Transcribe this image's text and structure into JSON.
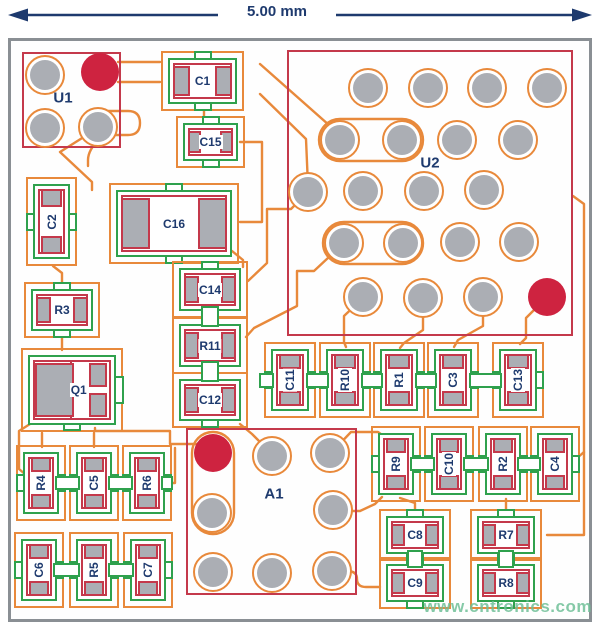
{
  "dimension": {
    "label": "5.00 mm"
  },
  "watermark": "www.cntronics.com",
  "colors": {
    "trace_orange": "#E8893B",
    "mask_green": "#2FA14D",
    "silk_red": "#C4394B",
    "pad_gray": "#ABAEB4",
    "mark_red": "#CE2340",
    "text_navy": "#1E3A6E",
    "board_border": "#8A8F94"
  },
  "chips": [
    {
      "label": "U1",
      "x": 22,
      "y": 52,
      "w": 99,
      "h": 96,
      "label_cx": 41,
      "label_cy": 46,
      "pads": [
        {
          "cx": 45,
          "cy": 75,
          "kind": "ring"
        },
        {
          "cx": 100,
          "cy": 72,
          "kind": "mark"
        },
        {
          "cx": 45,
          "cy": 128,
          "kind": "ring"
        },
        {
          "cx": 98,
          "cy": 127,
          "kind": "ring"
        }
      ]
    },
    {
      "label": "U2",
      "x": 287,
      "y": 50,
      "w": 286,
      "h": 286,
      "label_cx": 143,
      "label_cy": 113,
      "pads": [
        {
          "cx": 368,
          "cy": 88,
          "kind": "ring"
        },
        {
          "cx": 428,
          "cy": 88,
          "kind": "ring"
        },
        {
          "cx": 487,
          "cy": 88,
          "kind": "ring"
        },
        {
          "cx": 547,
          "cy": 88,
          "kind": "ring"
        },
        {
          "cx": 340,
          "cy": 140,
          "kind": "ring"
        },
        {
          "cx": 402,
          "cy": 140,
          "kind": "ring"
        },
        {
          "cx": 457,
          "cy": 140,
          "kind": "ring"
        },
        {
          "cx": 518,
          "cy": 140,
          "kind": "ring"
        },
        {
          "cx": 308,
          "cy": 192,
          "kind": "ring"
        },
        {
          "cx": 363,
          "cy": 191,
          "kind": "ring"
        },
        {
          "cx": 424,
          "cy": 191,
          "kind": "ring"
        },
        {
          "cx": 484,
          "cy": 190,
          "kind": "ring"
        },
        {
          "cx": 344,
          "cy": 243,
          "kind": "ring"
        },
        {
          "cx": 403,
          "cy": 243,
          "kind": "ring"
        },
        {
          "cx": 460,
          "cy": 242,
          "kind": "ring"
        },
        {
          "cx": 519,
          "cy": 242,
          "kind": "ring"
        },
        {
          "cx": 363,
          "cy": 297,
          "kind": "ring"
        },
        {
          "cx": 423,
          "cy": 298,
          "kind": "ring"
        },
        {
          "cx": 483,
          "cy": 297,
          "kind": "ring"
        },
        {
          "cx": 547,
          "cy": 297,
          "kind": "mark"
        }
      ]
    },
    {
      "label": "A1",
      "x": 186,
      "y": 428,
      "w": 171,
      "h": 167,
      "label_cx": 88,
      "label_cy": 66,
      "pads": [
        {
          "cx": 213,
          "cy": 453,
          "kind": "mark"
        },
        {
          "cx": 272,
          "cy": 456,
          "kind": "ring"
        },
        {
          "cx": 330,
          "cy": 453,
          "kind": "ring"
        },
        {
          "cx": 212,
          "cy": 513,
          "kind": "ring"
        },
        {
          "cx": 333,
          "cy": 510,
          "kind": "ring"
        },
        {
          "cx": 213,
          "cy": 572,
          "kind": "ring"
        },
        {
          "cx": 272,
          "cy": 573,
          "kind": "ring"
        },
        {
          "cx": 332,
          "cy": 571,
          "kind": "ring"
        }
      ]
    }
  ],
  "q1": {
    "label": "Q1",
    "x": 28,
    "y": 355,
    "w": 88,
    "h": 70
  },
  "passives": [
    {
      "label": "C1",
      "orient": "h",
      "x": 168,
      "y": 58,
      "w": 69,
      "h": 46
    },
    {
      "label": "C15",
      "orient": "h",
      "x": 183,
      "y": 123,
      "w": 55,
      "h": 38
    },
    {
      "label": "C2",
      "orient": "v",
      "x": 33,
      "y": 184,
      "w": 37,
      "h": 75
    },
    {
      "label": "C16",
      "orient": "h",
      "x": 116,
      "y": 190,
      "w": 116,
      "h": 67
    },
    {
      "label": "C14",
      "orient": "h",
      "x": 179,
      "y": 268,
      "w": 62,
      "h": 43
    },
    {
      "label": "R11",
      "orient": "h",
      "x": 179,
      "y": 324,
      "w": 62,
      "h": 43
    },
    {
      "label": "C12",
      "orient": "h",
      "x": 179,
      "y": 379,
      "w": 62,
      "h": 42
    },
    {
      "label": "R3",
      "orient": "h",
      "x": 31,
      "y": 289,
      "w": 62,
      "h": 42
    },
    {
      "label": "C11",
      "orient": "v",
      "x": 271,
      "y": 349,
      "w": 38,
      "h": 62
    },
    {
      "label": "R10",
      "orient": "v",
      "x": 326,
      "y": 349,
      "w": 38,
      "h": 62
    },
    {
      "label": "R1",
      "orient": "v",
      "x": 380,
      "y": 349,
      "w": 38,
      "h": 62
    },
    {
      "label": "C3",
      "orient": "v",
      "x": 434,
      "y": 349,
      "w": 38,
      "h": 62
    },
    {
      "label": "C13",
      "orient": "v",
      "x": 499,
      "y": 349,
      "w": 38,
      "h": 62
    },
    {
      "label": "R4",
      "orient": "v",
      "x": 23,
      "y": 452,
      "w": 36,
      "h": 62
    },
    {
      "label": "C5",
      "orient": "v",
      "x": 76,
      "y": 452,
      "w": 36,
      "h": 62
    },
    {
      "label": "R6",
      "orient": "v",
      "x": 129,
      "y": 452,
      "w": 36,
      "h": 62
    },
    {
      "label": "C6",
      "orient": "v",
      "x": 21,
      "y": 539,
      "w": 36,
      "h": 62
    },
    {
      "label": "R5",
      "orient": "v",
      "x": 76,
      "y": 539,
      "w": 36,
      "h": 62
    },
    {
      "label": "C7",
      "orient": "v",
      "x": 130,
      "y": 539,
      "w": 36,
      "h": 62
    },
    {
      "label": "R9",
      "orient": "v",
      "x": 378,
      "y": 433,
      "w": 36,
      "h": 62
    },
    {
      "label": "C10",
      "orient": "v",
      "x": 431,
      "y": 433,
      "w": 36,
      "h": 62
    },
    {
      "label": "R2",
      "orient": "v",
      "x": 485,
      "y": 433,
      "w": 36,
      "h": 62
    },
    {
      "label": "C4",
      "orient": "v",
      "x": 537,
      "y": 433,
      "w": 36,
      "h": 62
    },
    {
      "label": "C8",
      "orient": "h",
      "x": 386,
      "y": 516,
      "w": 58,
      "h": 38
    },
    {
      "label": "C9",
      "orient": "h",
      "x": 386,
      "y": 564,
      "w": 58,
      "h": 38
    },
    {
      "label": "R7",
      "orient": "h",
      "x": 477,
      "y": 516,
      "w": 58,
      "h": 38
    },
    {
      "label": "R8",
      "orient": "h",
      "x": 477,
      "y": 564,
      "w": 58,
      "h": 38
    }
  ]
}
